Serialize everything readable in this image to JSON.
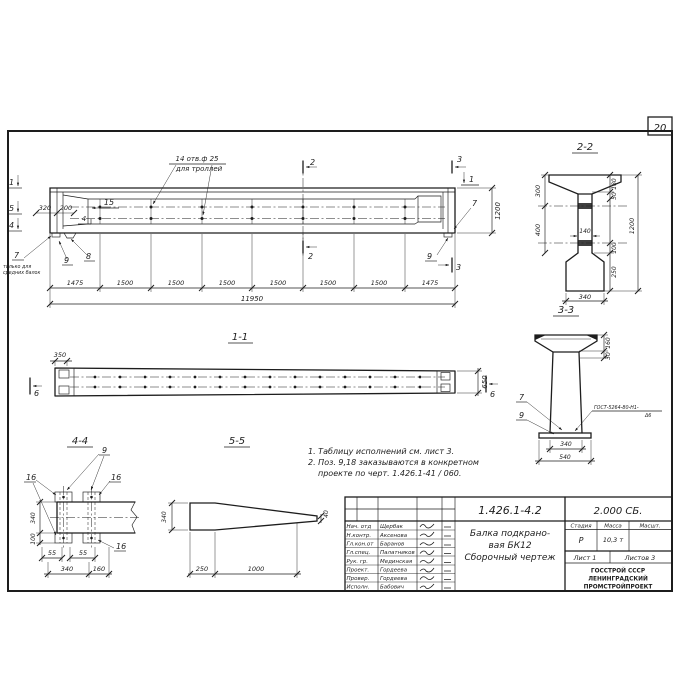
{
  "page": {
    "sheet_number": "20"
  },
  "colors": {
    "ink": "#1d1d1d",
    "paper": "#ffffff"
  },
  "main_view": {
    "cut_markers": {
      "m1": "1",
      "m5": "5",
      "m4": "4",
      "m2": "2",
      "m3": "3",
      "m1r": "1"
    },
    "dims": {
      "d320": "320",
      "d200": "200",
      "d1200": "1200",
      "total": "11950",
      "segments": [
        "1475",
        "1500",
        "1500",
        "1500",
        "1500",
        "1500",
        "1500",
        "1475"
      ]
    },
    "positions": {
      "p15": "15",
      "p4": "4",
      "p7r": "7",
      "p9r": "9",
      "p7l": "7",
      "p9l": "9",
      "p8": "8"
    },
    "holes_note": {
      "line1": "14 отв.ф 25",
      "line2": "для троллей"
    },
    "left_note": {
      "line1": "только для",
      "line2": "средних балок"
    }
  },
  "section_1_1": {
    "title": "1-1",
    "d350": "350",
    "d650": "650",
    "m6": "6"
  },
  "section_2_2": {
    "title": "2-2",
    "d300": "300",
    "d400": "400",
    "d140": "140",
    "d180": "180",
    "d50": "50",
    "d100": "100",
    "d250": "250",
    "d1200": "1200",
    "d340": "340"
  },
  "section_3_3": {
    "title": "3-3",
    "d160": "160",
    "d30": "30",
    "p7": "7",
    "p9": "9",
    "weld_line1": "ГОСТ-5264-80-Н1-",
    "weld_line2": "Δ6",
    "d340": "340",
    "d540": "540"
  },
  "section_4_4": {
    "title": "4-4",
    "p9": "9",
    "p16": "16",
    "d340v": "340",
    "d100": "100",
    "d55": "55",
    "d340b": "340",
    "d160": "160"
  },
  "section_5_5": {
    "title": "5-5",
    "d340": "340",
    "d40": "40",
    "d250": "250",
    "d1000": "1000"
  },
  "notes": {
    "line1": "1. Таблицу исполнений см. лист 3.",
    "line2": "2. Поз. 9,18 заказываются в конкретном",
    "line3": "проекте по черт. 1.426.1-41 / 060."
  },
  "title_block": {
    "doc_number": "1.426.1-4.2",
    "doc_code": "2.000 СБ.",
    "name_line1": "Балка подкрано-",
    "name_line2": "вая БК12",
    "name_line3": "Сборочный чертеж",
    "col_stage": "Стадия",
    "col_mass": "Масса",
    "col_scale": "Масшт.",
    "stage": "Р",
    "mass": "10,3 т",
    "sheet": "Лист 1",
    "sheets": "Листов 3",
    "org_line1": "ГОССТРОЙ СССР",
    "org_line2": "ЛЕНИНГРАДСКИЙ",
    "org_line3": "ПРОМСТРОЙПРОЕКТ",
    "roles": [
      {
        "role": "Нач. отд",
        "name": "Щербак"
      },
      {
        "role": "Н.контр.",
        "name": "Аксенова"
      },
      {
        "role": "Гл.кон.от",
        "name": "Баранов"
      },
      {
        "role": "Гл.спец.",
        "name": "Палатников"
      },
      {
        "role": "Рук. гр.",
        "name": "Мединская"
      },
      {
        "role": "Проект.",
        "name": "Гордеева"
      },
      {
        "role": "Провер.",
        "name": "Гордеева"
      },
      {
        "role": "Исполн.",
        "name": "Бабович"
      }
    ]
  }
}
